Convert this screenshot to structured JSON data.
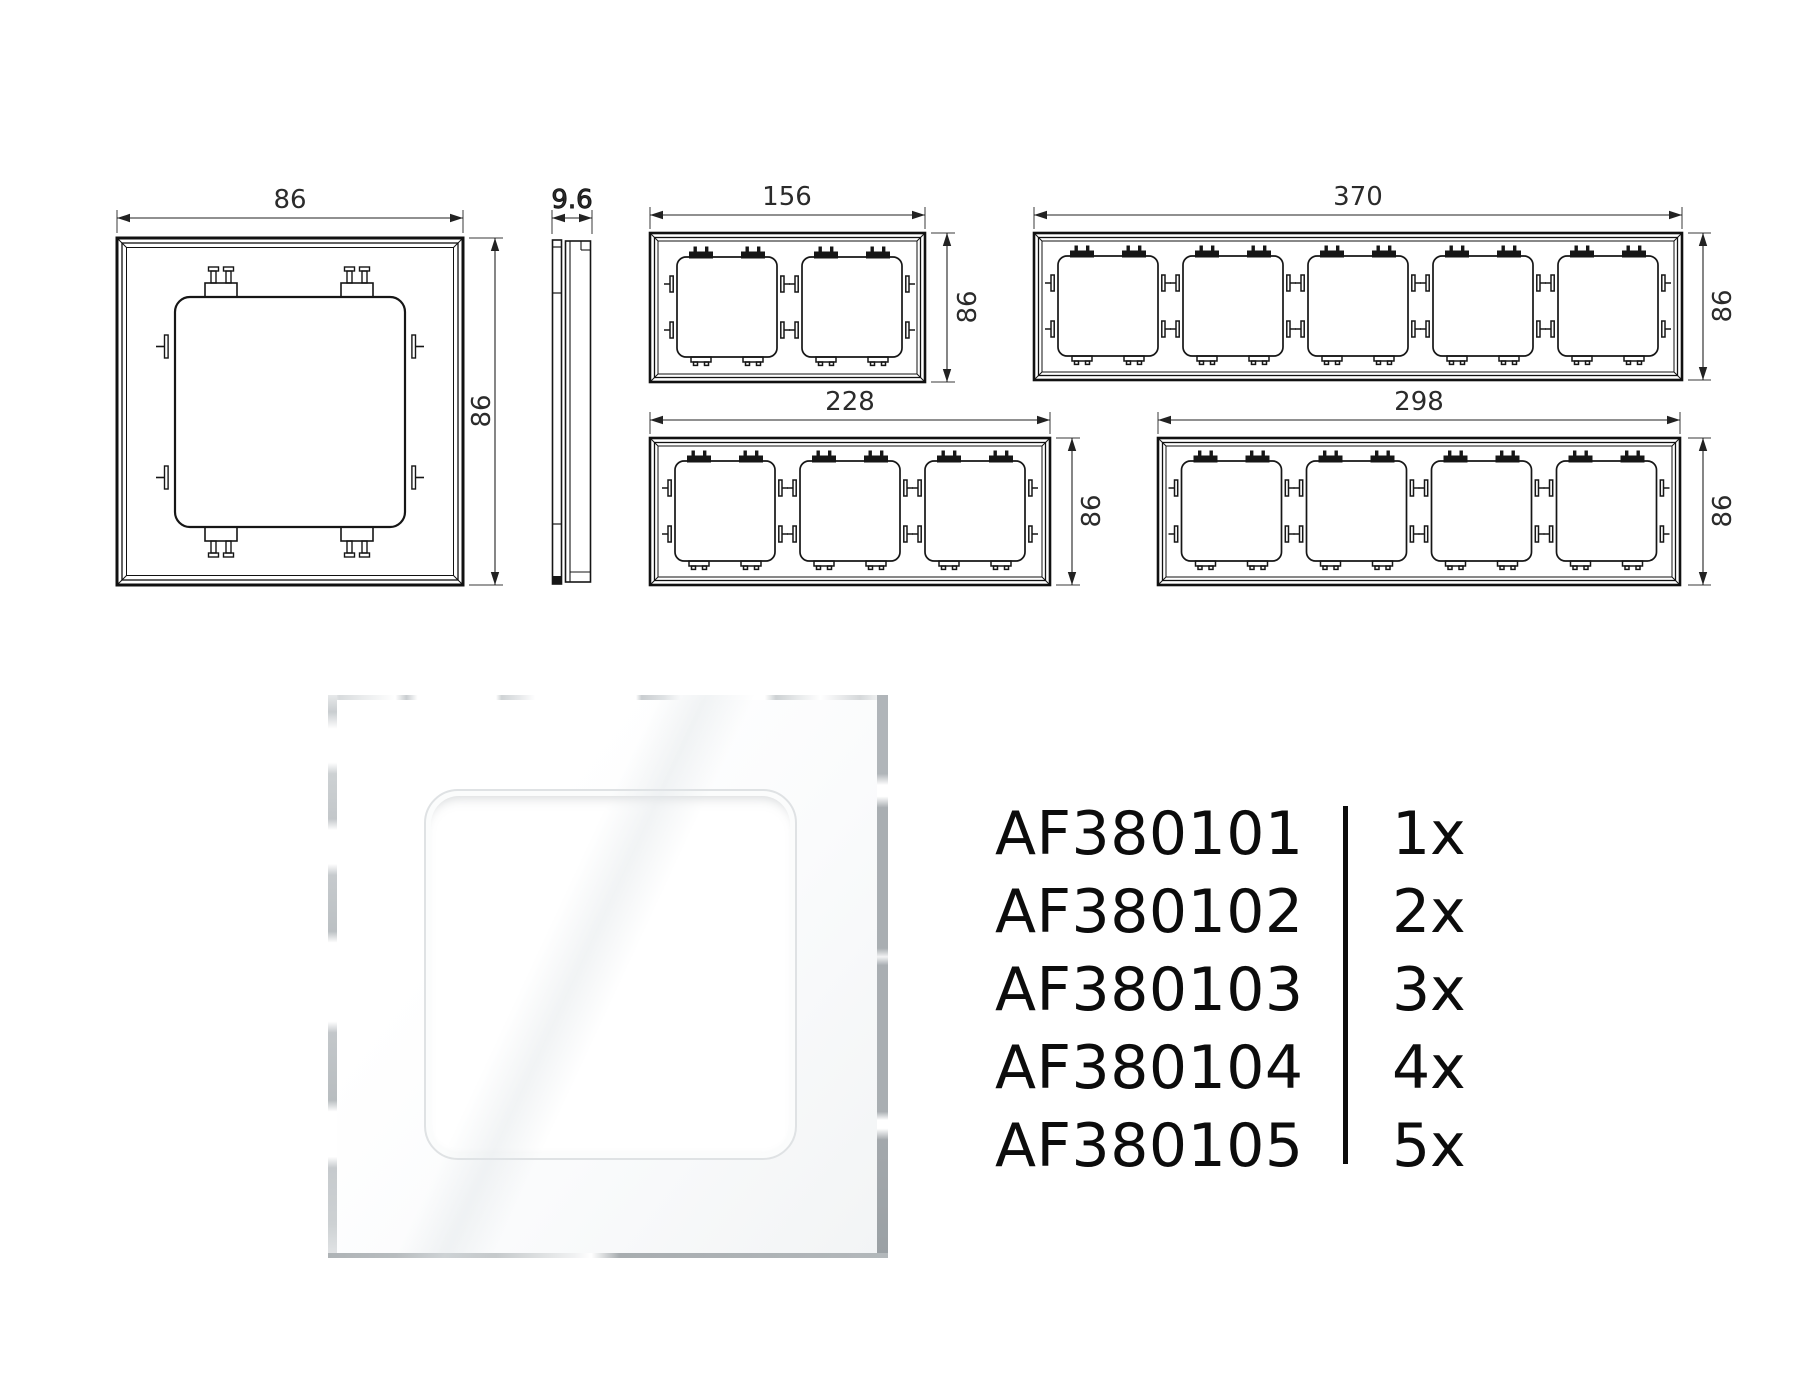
{
  "drawings": {
    "single_front": {
      "width_label": "86",
      "height_label": "86"
    },
    "side_profile": {
      "width_label": "9.6"
    },
    "gang2": {
      "width_label": "156",
      "height_label": "86"
    },
    "gang5": {
      "width_label": "370",
      "height_label": "86"
    },
    "gang3": {
      "width_label": "228",
      "height_label": "86"
    },
    "gang4": {
      "width_label": "298",
      "height_label": "86"
    }
  },
  "product_table": {
    "rows": [
      {
        "part_number": "AF380101",
        "quantity": "1x"
      },
      {
        "part_number": "AF380102",
        "quantity": "2x"
      },
      {
        "part_number": "AF380103",
        "quantity": "3x"
      },
      {
        "part_number": "AF380104",
        "quantity": "4x"
      },
      {
        "part_number": "AF380105",
        "quantity": "5x"
      }
    ]
  },
  "colors": {
    "line": "#161616",
    "text": "#0c0c0c",
    "dim_text": "#2b2b2b"
  }
}
